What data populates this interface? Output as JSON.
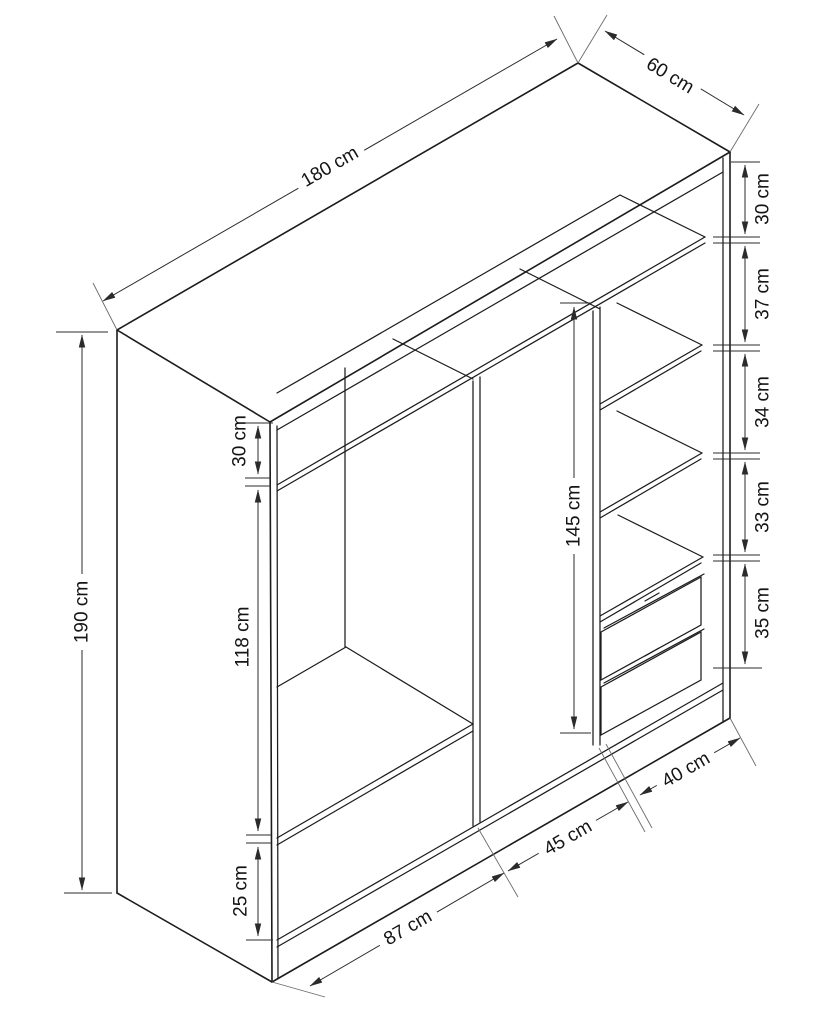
{
  "diagram": {
    "kind": "isometric furniture dimension drawing",
    "subject": "three-section wardrobe with shelves and two drawers",
    "unit": "cm",
    "background_color": "#ffffff",
    "line_color": "#1c1c1c",
    "overall": {
      "width": "180 cm",
      "depth": "60 cm",
      "height": "190 cm"
    },
    "right_shelf_column_gaps": [
      "30 cm",
      "37 cm",
      "34 cm",
      "33 cm",
      "35 cm"
    ],
    "left_section": {
      "top_gap": "30 cm",
      "hanging_space": "118 cm",
      "bottom_gap": "25 cm"
    },
    "middle_section": {
      "height": "145 cm"
    },
    "bottom_section_widths": [
      "87 cm",
      "45 cm",
      "40 cm"
    ]
  }
}
